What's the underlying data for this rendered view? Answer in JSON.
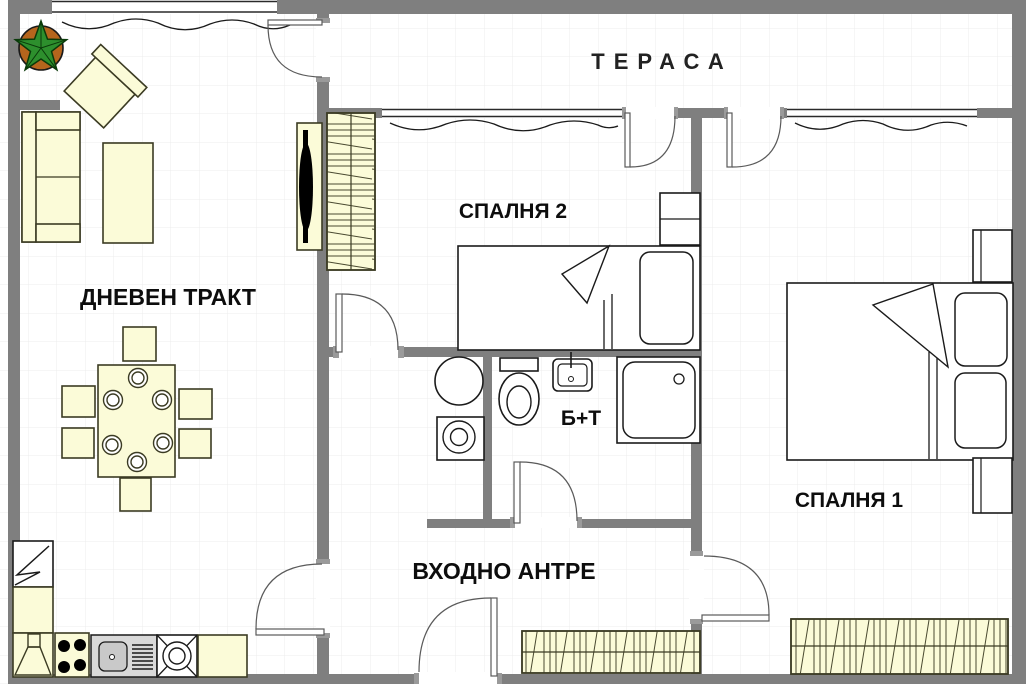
{
  "title": "Apartment floor plan",
  "labels": {
    "terrace": "ТЕРАСА",
    "bedroom2": "СПАЛНЯ 2",
    "living_room": "ДНЕВЕН ТРАКТ",
    "bathroom": "Б+Т",
    "entrance_hall": "ВХОДНО АНТРЕ",
    "bedroom1": "СПАЛНЯ 1"
  },
  "colors": {
    "wall": "#7f7f7f",
    "furniture_fill": "#fbfbd8",
    "outline": "#3b3b23",
    "grid_line": "#ececec",
    "background": "#ffffff",
    "plant_leaves": "#2d8f2d",
    "plant_pot": "#b5651d",
    "sink_counter": "#d9d9d9",
    "tv": "#000000"
  },
  "rooms": [
    {
      "id": "terrace",
      "label": "ТЕРАСА",
      "furniture": []
    },
    {
      "id": "living_room",
      "label": "ДНЕВЕН ТРАКТ",
      "furniture": [
        "potted-plant",
        "armchair",
        "sofa",
        "coffee-table",
        "tv-stand",
        "dining-table",
        "chair-x6",
        "plates-x6",
        "fridge",
        "kitchen-cabinet",
        "cooker-hood",
        "stove",
        "kitchen-sink",
        "dishwasher",
        "kitchen-counter"
      ]
    },
    {
      "id": "bedroom2",
      "label": "СПАЛНЯ 2",
      "furniture": [
        "wardrobe",
        "single-bed",
        "nightstand"
      ]
    },
    {
      "id": "bathroom",
      "label": "Б+Т",
      "furniture": [
        "boiler",
        "washing-machine",
        "toilet",
        "washbasin",
        "shower-cabin"
      ]
    },
    {
      "id": "entrance_hall",
      "label": "ВХОДНО АНТРЕ",
      "furniture": [
        "wardrobe"
      ]
    },
    {
      "id": "bedroom1",
      "label": "СПАЛНЯ 1",
      "furniture": [
        "double-bed",
        "nightstand-x2",
        "wardrobe"
      ]
    }
  ],
  "doors": [
    "living-terrace-door",
    "bedroom2-terrace-door",
    "bedroom1-terrace-door",
    "bedroom2-door",
    "bathroom-door",
    "living-hall-door",
    "entry-door",
    "bedroom1-door"
  ],
  "windows": [
    "living-room-window",
    "bedroom2-window",
    "bedroom1-window"
  ]
}
